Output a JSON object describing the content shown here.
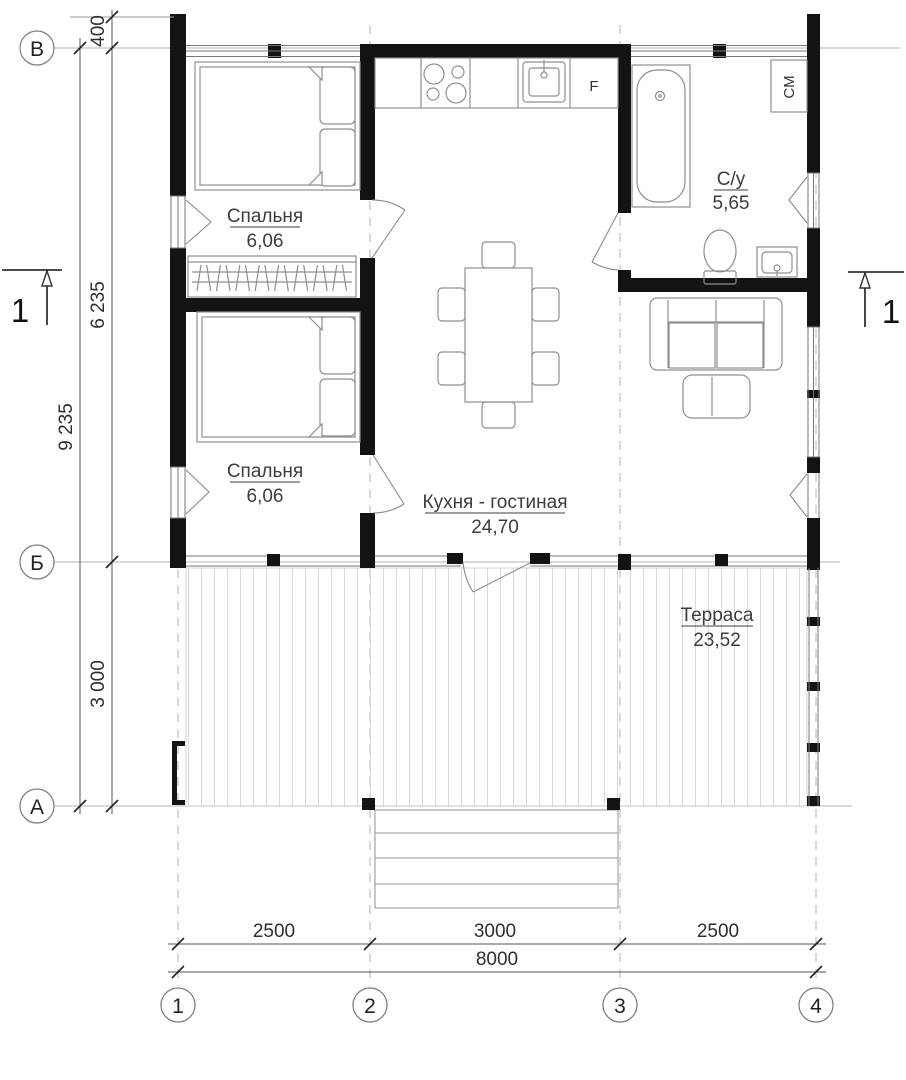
{
  "grid": {
    "rows": [
      "В",
      "Б",
      "А"
    ],
    "cols": [
      "1",
      "2",
      "3",
      "4"
    ]
  },
  "dimensions": {
    "left_offset": "400",
    "left_upper": "6 235",
    "left_lower": "3 000",
    "left_total": "9 235",
    "bottom_bay1": "2500",
    "bottom_bay2": "3000",
    "bottom_bay3": "2500",
    "bottom_total": "8000"
  },
  "rooms": {
    "bedroom1": {
      "name": "Спальня",
      "area": "6,06"
    },
    "bedroom2": {
      "name": "Спальня",
      "area": "6,06"
    },
    "kitchen_living": {
      "name": "Кухня - гостиная",
      "area": "24,70"
    },
    "bathroom": {
      "name": "С/у",
      "area": "5,65"
    },
    "terrace": {
      "name": "Терраса",
      "area": "23,52"
    }
  },
  "appliances": {
    "fridge": "F",
    "washing_machine": "СМ"
  },
  "section": {
    "label": "1"
  }
}
